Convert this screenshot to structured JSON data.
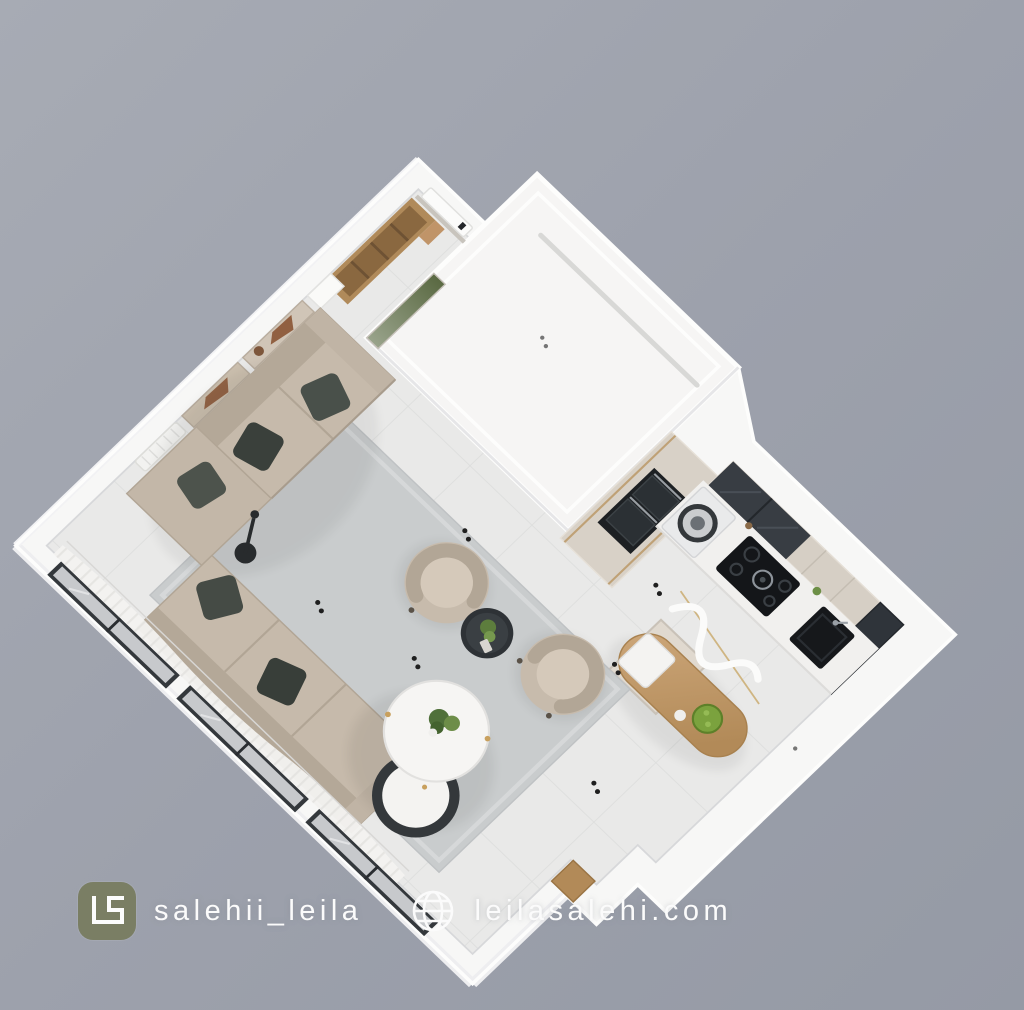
{
  "watermark": {
    "monogram": "LS",
    "handle": "salehii_leila",
    "website": "leilasalehi.com",
    "logo_background": "#7a7e64",
    "text_color": "#fbfbfb",
    "globe_icon": "globe-icon"
  },
  "scene": {
    "type": "3d-isometric-apartment-render",
    "view": "top-down isometric, rotated 45 degrees",
    "background_top": "#a7abb4",
    "background_bottom": "#959aa5",
    "rooms": [
      {
        "name": "entry-hall",
        "features": [
          "entry-door-white-leaf",
          "wood-wardrobe-unit",
          "green-textured-panel"
        ]
      },
      {
        "name": "closed-utility-block",
        "features": [
          "white-roof-top-face",
          "recessed-ceiling-groove"
        ]
      },
      {
        "name": "kitchen",
        "features": [
          "tall-units-with-black-double-oven",
          "washing-machine",
          "black-gas-hob",
          "black-sink",
          "dark-glass-upper-cabinets",
          "corner-dark-glass-cabinet",
          "island-with-wood-dining-top",
          "green-fruit-bowl",
          "white-curvy-pendant-light"
        ]
      },
      {
        "name": "living-dining-room",
        "features": [
          "l-shaped-beige-sofa",
          "dark-green-pillows",
          "two-beige-tub-armchairs",
          "round-white-nesting-coffee-tables",
          "plant-centerpiece",
          "dark-round-side-table",
          "gray-area-rug",
          "two-abstract-wall-art-panels",
          "white-radiator",
          "black-floor-lamp",
          "window-wall-with-sheer-curtains",
          "wood-threshold"
        ]
      }
    ],
    "palette": {
      "wall_white": "#f7f7f6",
      "floor_tile": "#e9e9e8",
      "tile_grout": "#dcdddc",
      "rug_gray": "#c9cccd",
      "sofa_beige": "#c6baab",
      "pillow_dark_green": "#49504a",
      "wood_oak": "#c19a6b",
      "cabinet_greige": "#d6cfc5",
      "appliance_black": "#17191c",
      "glass_dark": "#383d43",
      "plant_green": "#5d7d3d",
      "curtain_white": "#f3f2f0",
      "gold_accent": "#cdb078"
    }
  }
}
